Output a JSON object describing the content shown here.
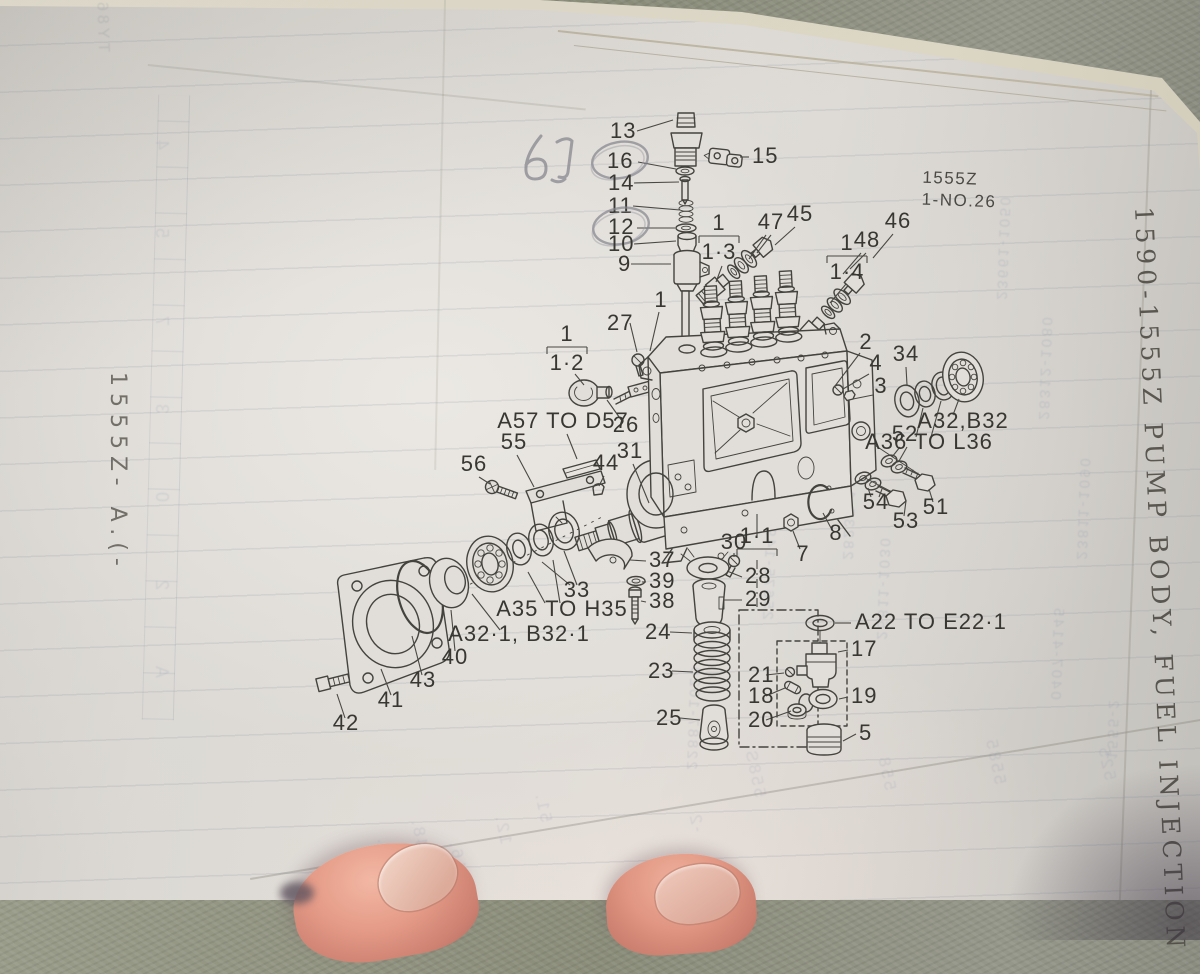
{
  "page": {
    "left_margin": "1555Z- A.(-",
    "right_margin": "1590-1555Z  PUMP BODY, FUEL INJECTION",
    "sheet_code": "1555Z",
    "sheet_no": "1-NO.26",
    "handwritten_note": "6J"
  },
  "colors": {
    "page": "#e3e0db",
    "page_edge": "#ece7d8",
    "concrete": "#8e907e",
    "ink": "#45433e",
    "pencil": "#83838b",
    "ghost_showthrough": "#6f7ca3",
    "skin": "#e59c88"
  },
  "diagram": {
    "callouts": [
      {
        "t": "13",
        "x": 610,
        "y": 138,
        "a": "start",
        "l": [
          [
            637,
            131,
            673,
            120
          ]
        ]
      },
      {
        "t": "16",
        "x": 607,
        "y": 168,
        "a": "start",
        "c": [
          620,
          160
        ],
        "l": [
          [
            638,
            162,
            676,
            169
          ]
        ]
      },
      {
        "t": "14",
        "x": 608,
        "y": 190,
        "a": "start",
        "l": [
          [
            634,
            183,
            679,
            182
          ]
        ]
      },
      {
        "t": "15",
        "x": 752,
        "y": 163,
        "a": "start",
        "l": [
          [
            749,
            157,
            740,
            157
          ]
        ]
      },
      {
        "t": "11",
        "x": 608,
        "y": 213,
        "a": "start",
        "l": [
          [
            633,
            206,
            680,
            210
          ]
        ]
      },
      {
        "t": "12",
        "x": 608,
        "y": 234,
        "a": "start",
        "c": [
          621,
          226
        ],
        "l": [
          [
            637,
            228,
            675,
            228
          ]
        ]
      },
      {
        "t": "10",
        "x": 608,
        "y": 251,
        "a": "start",
        "l": [
          [
            634,
            244,
            676,
            241
          ]
        ]
      },
      {
        "t": "9",
        "x": 618,
        "y": 271,
        "a": "start",
        "l": [
          [
            631,
            264,
            671,
            264
          ]
        ]
      },
      {
        "t": "1",
        "x": 661,
        "y": 307,
        "l": [
          [
            659,
            312,
            650,
            351
          ]
        ]
      },
      {
        "t": "27",
        "x": 607,
        "y": 330,
        "a": "start",
        "l": [
          [
            630,
            323,
            637,
            352
          ]
        ]
      },
      {
        "t": "45",
        "x": 800,
        "y": 221,
        "l": [
          [
            795,
            227,
            775,
            245
          ]
        ]
      },
      {
        "t": "47",
        "x": 771,
        "y": 229,
        "l": [
          [
            766,
            235,
            749,
            259
          ],
          [
            771,
            235,
            757,
            253
          ]
        ]
      },
      {
        "t": "46",
        "x": 898,
        "y": 228,
        "l": [
          [
            893,
            234,
            873,
            258
          ]
        ]
      },
      {
        "t": "48",
        "x": 867,
        "y": 247,
        "l": [
          [
            861,
            253,
            843,
            274
          ],
          [
            866,
            253,
            850,
            269
          ]
        ]
      },
      {
        "t": "2",
        "x": 866,
        "y": 349,
        "l": [
          [
            860,
            353,
            835,
            386
          ]
        ]
      },
      {
        "t": "34",
        "x": 906,
        "y": 361,
        "l": [
          [
            906,
            367,
            907,
            385
          ]
        ]
      },
      {
        "t": "4",
        "x": 876,
        "y": 370,
        "l": [
          [
            869,
            374,
            843,
            389
          ]
        ]
      },
      {
        "t": "3",
        "x": 881,
        "y": 393,
        "l": [
          [
            873,
            395,
            853,
            399
          ]
        ]
      },
      {
        "t": "26",
        "x": 626,
        "y": 432,
        "l": [
          [
            622,
            421,
            607,
            400
          ]
        ]
      },
      {
        "t": "31",
        "x": 630,
        "y": 458,
        "l": [
          [
            633,
            464,
            649,
            503
          ]
        ]
      },
      {
        "t": "44",
        "x": 606,
        "y": 470,
        "l": [
          [
            604,
            476,
            599,
            486
          ]
        ]
      },
      {
        "t": "55",
        "x": 514,
        "y": 449,
        "l": [
          [
            517,
            455,
            534,
            487
          ]
        ]
      },
      {
        "t": "56",
        "x": 474,
        "y": 471,
        "l": [
          [
            479,
            477,
            490,
            484
          ]
        ]
      },
      {
        "t": "30",
        "x": 734,
        "y": 549,
        "l": [
          [
            734,
            553,
            734,
            557
          ]
        ]
      },
      {
        "t": "7",
        "x": 803,
        "y": 561,
        "l": [
          [
            800,
            549,
            793,
            531
          ]
        ]
      },
      {
        "t": "8",
        "x": 836,
        "y": 540,
        "l": [
          [
            831,
            528,
            823,
            513
          ]
        ]
      },
      {
        "t": "37",
        "x": 649,
        "y": 567,
        "a": "start",
        "l": [
          [
            646,
            561,
            630,
            560
          ]
        ]
      },
      {
        "t": "39",
        "x": 649,
        "y": 588,
        "a": "start",
        "l": [
          [
            646,
            582,
            642,
            582
          ]
        ]
      },
      {
        "t": "38",
        "x": 649,
        "y": 608,
        "a": "start",
        "l": [
          [
            646,
            602,
            641,
            601
          ]
        ]
      },
      {
        "t": "28",
        "x": 745,
        "y": 583,
        "a": "start",
        "l": [
          [
            742,
            577,
            727,
            571
          ]
        ]
      },
      {
        "t": "29",
        "x": 745,
        "y": 606,
        "a": "start",
        "l": [
          [
            742,
            600,
            723,
            600
          ]
        ]
      },
      {
        "t": "24",
        "x": 645,
        "y": 639,
        "a": "start",
        "l": [
          [
            670,
            632,
            692,
            633
          ]
        ]
      },
      {
        "t": "23",
        "x": 648,
        "y": 678,
        "a": "start",
        "l": [
          [
            672,
            671,
            693,
            672
          ]
        ]
      },
      {
        "t": "25",
        "x": 656,
        "y": 725,
        "a": "start",
        "l": [
          [
            680,
            718,
            700,
            720
          ]
        ]
      },
      {
        "t": "33",
        "x": 577,
        "y": 597,
        "l": [
          [
            570,
            585,
            542,
            562
          ],
          [
            577,
            585,
            564,
            551
          ]
        ]
      },
      {
        "t": "40",
        "x": 455,
        "y": 664,
        "l": [
          [
            455,
            651,
            451,
            610
          ]
        ]
      },
      {
        "t": "43",
        "x": 423,
        "y": 687,
        "l": [
          [
            422,
            675,
            412,
            636
          ]
        ]
      },
      {
        "t": "41",
        "x": 391,
        "y": 707,
        "l": [
          [
            391,
            695,
            381,
            669
          ]
        ]
      },
      {
        "t": "42",
        "x": 346,
        "y": 730,
        "l": [
          [
            345,
            718,
            337,
            694
          ]
        ]
      },
      {
        "t": "52",
        "x": 905,
        "y": 441,
        "l": [
          [
            900,
            447,
            892,
            457
          ],
          [
            907,
            447,
            899,
            461
          ]
        ]
      },
      {
        "t": "51",
        "x": 936,
        "y": 514,
        "l": [
          [
            933,
            502,
            929,
            489
          ]
        ]
      },
      {
        "t": "54",
        "x": 876,
        "y": 509,
        "l": [
          [
            871,
            497,
            868,
            488
          ],
          [
            879,
            497,
            882,
            489
          ]
        ]
      },
      {
        "t": "53",
        "x": 906,
        "y": 528,
        "l": [
          [
            904,
            516,
            906,
            501
          ]
        ]
      },
      {
        "t": "17",
        "x": 851,
        "y": 656,
        "a": "start",
        "l": [
          [
            848,
            650,
            838,
            652
          ]
        ]
      },
      {
        "t": "21",
        "x": 748,
        "y": 682,
        "a": "start",
        "l": [
          [
            766,
            675,
            784,
            673
          ]
        ]
      },
      {
        "t": "18",
        "x": 748,
        "y": 703,
        "a": "start",
        "l": [
          [
            766,
            696,
            785,
            688
          ]
        ]
      },
      {
        "t": "19",
        "x": 851,
        "y": 703,
        "a": "start",
        "l": [
          [
            848,
            697,
            839,
            699
          ]
        ]
      },
      {
        "t": "20",
        "x": 748,
        "y": 727,
        "a": "start",
        "l": [
          [
            766,
            720,
            791,
            711
          ]
        ]
      },
      {
        "t": "5",
        "x": 859,
        "y": 740,
        "a": "start",
        "l": [
          [
            856,
            734,
            843,
            741
          ]
        ]
      },
      {
        "t": "A57 TO D57",
        "x": 563,
        "y": 428,
        "fs": 18,
        "l": [
          [
            567,
            434,
            577,
            459
          ]
        ]
      },
      {
        "t": "A35 TO H35",
        "x": 562,
        "y": 616,
        "fs": 18,
        "l": [
          [
            545,
            603,
            528,
            572
          ],
          [
            560,
            603,
            553,
            560
          ]
        ]
      },
      {
        "t": "A32·1, B32·1",
        "x": 519,
        "y": 641,
        "fs": 18,
        "l": [
          [
            500,
            630,
            472,
            594
          ]
        ]
      },
      {
        "t": "A32,B32",
        "x": 963,
        "y": 428,
        "fs": 18,
        "l": [
          [
            953,
            415,
            959,
            399
          ]
        ]
      },
      {
        "t": "A36 TO L36",
        "x": 929,
        "y": 449,
        "fs": 18,
        "l": [
          [
            916,
            437,
            923,
            408
          ],
          [
            931,
            437,
            941,
            401
          ]
        ]
      },
      {
        "t": "A22 TO E22·1",
        "x": 855,
        "y": 629,
        "a": "start",
        "fs": 18,
        "l": [
          [
            835,
            623,
            851,
            623
          ]
        ]
      }
    ],
    "brackets": [
      {
        "t": "1·2",
        "x": 567,
        "y": 347,
        "l": [
          [
            575,
            374,
            584,
            385
          ]
        ]
      },
      {
        "t": "1·3",
        "x": 719,
        "y": 236,
        "l": [
          [
            722,
            266,
            716,
            282
          ]
        ]
      },
      {
        "t": "1·4",
        "x": 847,
        "y": 256,
        "l": [
          [
            846,
            284,
            830,
            303
          ]
        ]
      },
      {
        "t": "1·1",
        "x": 757,
        "y": 549,
        "flip": true,
        "l": [
          [
            757,
            514,
            757,
            536
          ],
          [
            757,
            560,
            757,
            608,
            1
          ]
        ]
      }
    ]
  },
  "ghost": {
    "columns": [
      {
        "t": "23231-1000",
        "x": 742,
        "y": 560
      },
      {
        "t": "25675-1490",
        "x": 776,
        "y": 620
      },
      {
        "t": "28235-1270",
        "x": 856,
        "y": 560
      },
      {
        "t": "25811-1030",
        "x": 890,
        "y": 640
      },
      {
        "t": "22887-1020",
        "x": 700,
        "y": 770
      },
      {
        "t": "23661-1050",
        "x": 1010,
        "y": 300
      },
      {
        "t": "28312-1080",
        "x": 1052,
        "y": 420
      },
      {
        "t": "23811-1090",
        "x": 1090,
        "y": 560
      },
      {
        "t": "0407-4145",
        "x": 1064,
        "y": 700
      },
      {
        "t": "1555-2",
        "x": 1120,
        "y": 760
      }
    ],
    "bottom": [
      {
        "t": "558S",
        "x": 770,
        "y": 795
      },
      {
        "t": "558",
        "x": 900,
        "y": 788
      },
      {
        "t": "5585",
        "x": 1010,
        "y": 782
      },
      {
        "t": "525",
        "x": 1120,
        "y": 778
      },
      {
        "t": "48.",
        "x": 432,
        "y": 846
      },
      {
        "t": "41.",
        "x": 398,
        "y": 864
      },
      {
        "t": "12.",
        "x": 516,
        "y": 842
      },
      {
        "t": "16.",
        "x": 470,
        "y": 868
      },
      {
        "t": "51.",
        "x": 556,
        "y": 820
      },
      {
        "t": "-2",
        "x": 708,
        "y": 830
      }
    ],
    "left_top": {
      "t": "TY860 -0A T60",
      "x": 112,
      "y": 52
    },
    "grid_chars": [
      "4",
      "5",
      "7",
      "3",
      "0",
      "2",
      "A"
    ]
  }
}
